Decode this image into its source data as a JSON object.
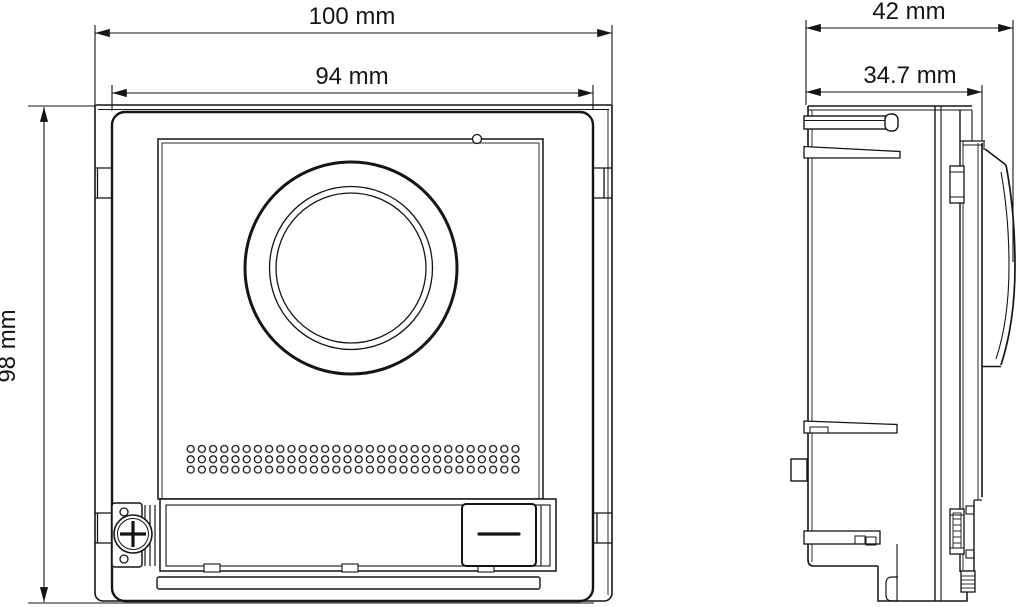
{
  "drawing": {
    "type": "technical-dimension-drawing",
    "subject": "video-intercom-camera-module",
    "background_color": "#ffffff",
    "line_color": "#151515",
    "views": {
      "front_view": {
        "features": [
          "mounting-frame",
          "front-panel",
          "camera-lens-rings",
          "indicator-hole",
          "speaker-hole-grid",
          "call-button",
          "screw-plate",
          "phillips-screw",
          "bottom-strip",
          "bottom-plate"
        ]
      },
      "side_view": {
        "features": [
          "module-body",
          "mounting-tabs",
          "panel-edge",
          "camera-dome-lens",
          "latch-clips",
          "bottom-foot"
        ]
      }
    },
    "dimensions": {
      "overall_width": {
        "label": "100 mm",
        "orientation": "horizontal"
      },
      "panel_width": {
        "label": "94 mm",
        "orientation": "horizontal"
      },
      "overall_height": {
        "label": "98 mm",
        "orientation": "vertical"
      },
      "overall_depth": {
        "label": "42 mm",
        "orientation": "horizontal"
      },
      "body_depth": {
        "label": "34.7 mm",
        "orientation": "horizontal"
      }
    },
    "speaker_grid": {
      "rows": 3,
      "columns": 30
    }
  }
}
